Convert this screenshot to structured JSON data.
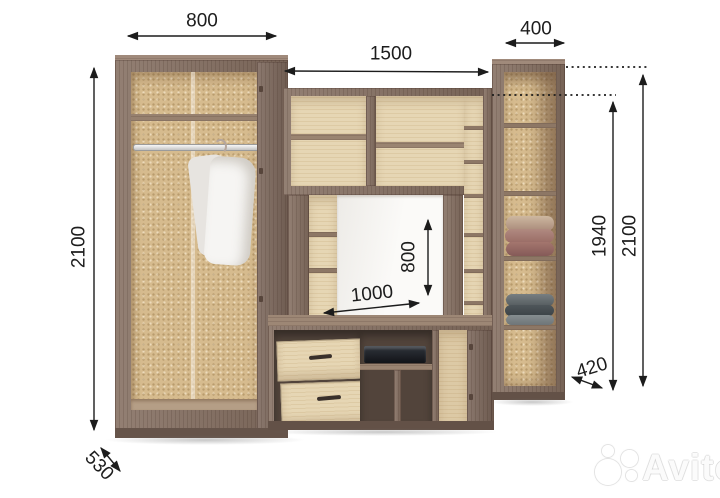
{
  "diagram": {
    "kind": "furniture-dimension-drawing",
    "subject": "wall-unit with wardrobe, TV niche and open shelf cabinet"
  },
  "dims": {
    "wardrobe_width": "800",
    "cabinet_width": "400",
    "center_width": "1500",
    "height_left": "2100",
    "wardrobe_depth": "530",
    "niche_height": "800",
    "niche_width": "1000",
    "center_height": "1940",
    "height_right": "2100",
    "cabinet_depth": "420"
  },
  "watermark": {
    "brand": "Avito"
  },
  "colors": {
    "background": "#ffffff",
    "wood_dark": "#846e60",
    "wood_light": "#e6d6b4",
    "cork_back": "#d6bb8e",
    "dimension_line": "#1c1c1c"
  }
}
